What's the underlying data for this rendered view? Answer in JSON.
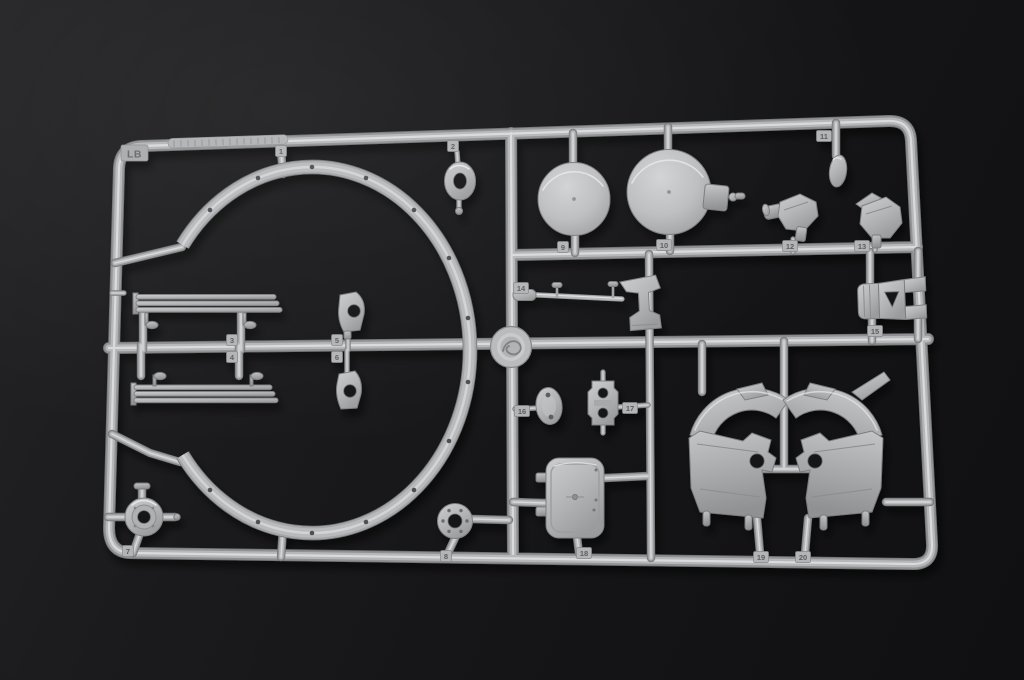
{
  "sprue": {
    "letter_label": "LB"
  },
  "part_tags": [
    {
      "label": "1",
      "x": 281,
      "y": 151
    },
    {
      "label": "2",
      "x": 453,
      "y": 146
    },
    {
      "label": "3",
      "x": 232,
      "y": 340
    },
    {
      "label": "4",
      "x": 232,
      "y": 357
    },
    {
      "label": "5",
      "x": 337,
      "y": 340
    },
    {
      "label": "6",
      "x": 337,
      "y": 357
    },
    {
      "label": "7",
      "x": 128,
      "y": 551
    },
    {
      "label": "8",
      "x": 446,
      "y": 556
    },
    {
      "label": "9",
      "x": 563,
      "y": 247
    },
    {
      "label": "10",
      "x": 664,
      "y": 245
    },
    {
      "label": "11",
      "x": 824,
      "y": 136
    },
    {
      "label": "12",
      "x": 790,
      "y": 246
    },
    {
      "label": "13",
      "x": 862,
      "y": 246
    },
    {
      "label": "14",
      "x": 521,
      "y": 288
    },
    {
      "label": "15",
      "x": 875,
      "y": 331
    },
    {
      "label": "16",
      "x": 522,
      "y": 411
    },
    {
      "label": "17",
      "x": 630,
      "y": 408
    },
    {
      "label": "18",
      "x": 584,
      "y": 553
    },
    {
      "label": "19",
      "x": 761,
      "y": 557
    },
    {
      "label": "20",
      "x": 803,
      "y": 557
    }
  ],
  "colors": {
    "background": "#17171a",
    "plastic": "#b4b6b8",
    "plastic_highlight": "#e2e3e4",
    "plastic_shadow": "#84868a",
    "tag_number_text": "#5b5d5f"
  }
}
